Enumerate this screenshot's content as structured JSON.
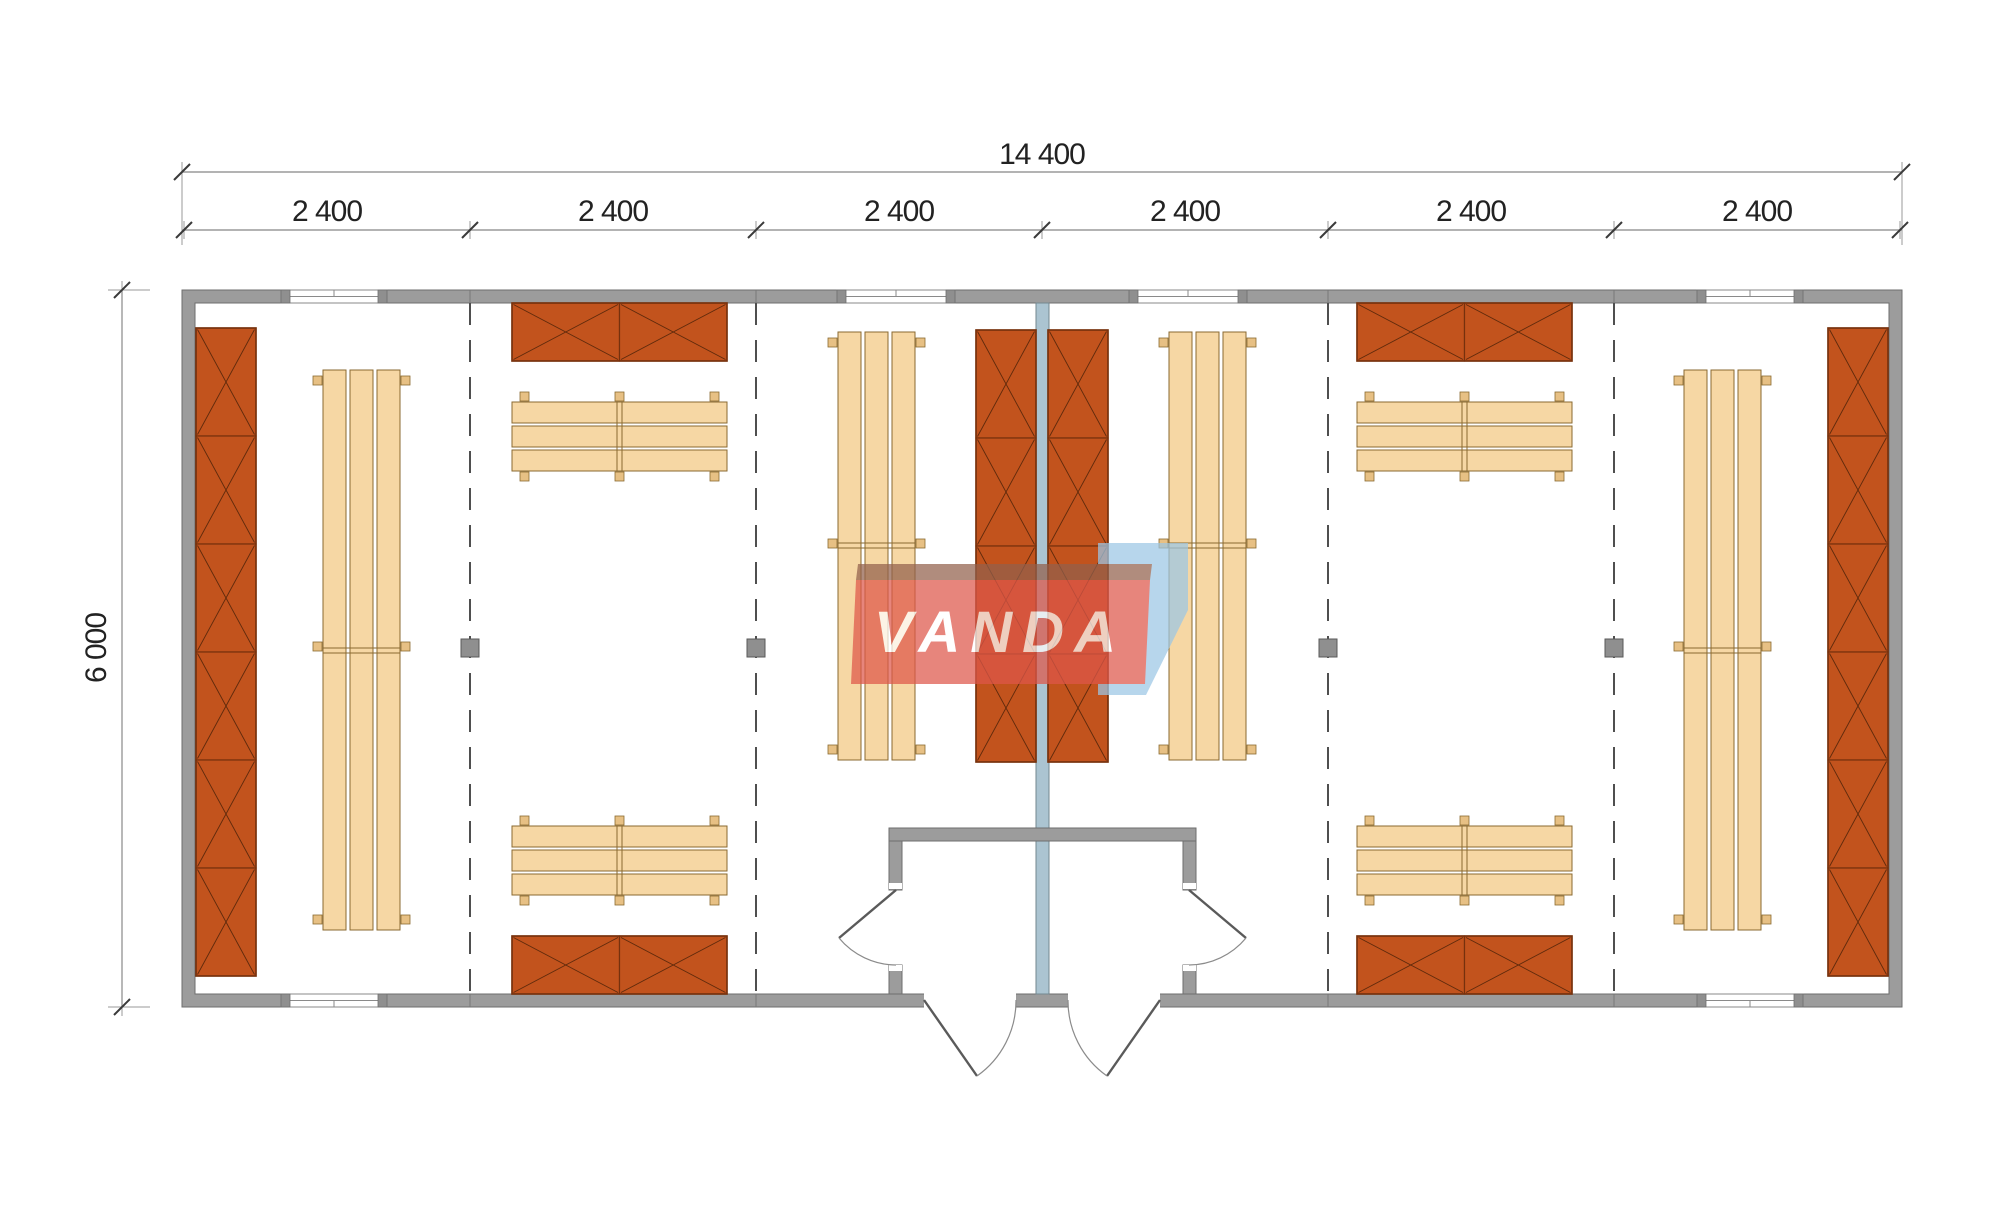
{
  "dimensions": {
    "total_width_label": "14 400",
    "bay_labels": [
      "2 400",
      "2 400",
      "2 400",
      "2 400",
      "2 400",
      "2 400"
    ],
    "height_label": "6 000"
  },
  "watermark": {
    "text": "VANDA",
    "red": "#df574a",
    "fold": "#93604c",
    "blue": "#9cc7e6"
  },
  "colors": {
    "background": "#ffffff",
    "wall": "#9c9c9c",
    "partition_wall": "#abc4d1",
    "locker": "#c2531d",
    "locker_outline": "#76310d",
    "bench": "#f6d7a4",
    "bench_outline": "#8a6a30",
    "dimension_text": "#222222"
  },
  "plan_summary": {
    "bays": 6,
    "rooms": 2,
    "locker_units": 8,
    "benches": 8,
    "windows_top_wall": 4,
    "windows_bottom_wall": 2,
    "door_leaves": 4,
    "columns": 4
  }
}
